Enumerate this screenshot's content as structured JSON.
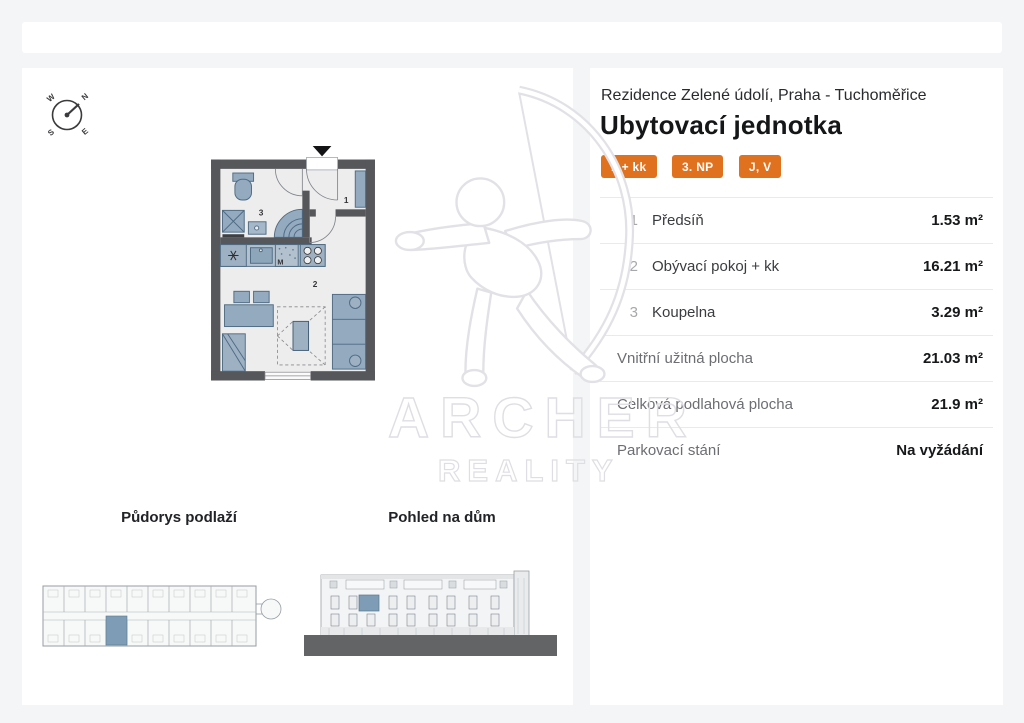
{
  "colors": {
    "accent": "#E0711E",
    "page_bg": "#f4f5f7",
    "wall": "#56575A",
    "fixture": "#93AABF",
    "highlight": "#7E9CB5",
    "ground": "#636466"
  },
  "header": {
    "project": "Rezidence Zelené údolí, Praha - Tuchoměřice",
    "title": "Ubytovací jednotka",
    "badges": [
      "1 + kk",
      "3. NP",
      "J, V"
    ]
  },
  "areas": {
    "rooms": [
      {
        "num": "1",
        "label": "Předsíň",
        "value": "1.53 m²"
      },
      {
        "num": "2",
        "label": "Obývací pokoj + kk",
        "value": "16.21 m²"
      },
      {
        "num": "3",
        "label": "Koupelna",
        "value": "3.29 m²"
      }
    ],
    "totals": [
      {
        "label": "Vnitřní užitná plocha",
        "value": "21.03 m²"
      },
      {
        "label": "Celková podlahová plocha",
        "value": "21.9 m²"
      },
      {
        "label": "Parkovací stání",
        "value": "Na vyžádání"
      }
    ]
  },
  "floorplan": {
    "labels": {
      "hallway": "1",
      "living_room": "2",
      "bathroom": "3",
      "kitchen": "M"
    }
  },
  "compass": {
    "n": "N",
    "e": "E",
    "s": "S",
    "w": "W"
  },
  "thumbnails": {
    "floor_title": "Půdorys podlaží",
    "elevation_title": "Pohled na dům"
  },
  "watermark": {
    "name": "ARCHER",
    "tagline": "REALITY"
  }
}
